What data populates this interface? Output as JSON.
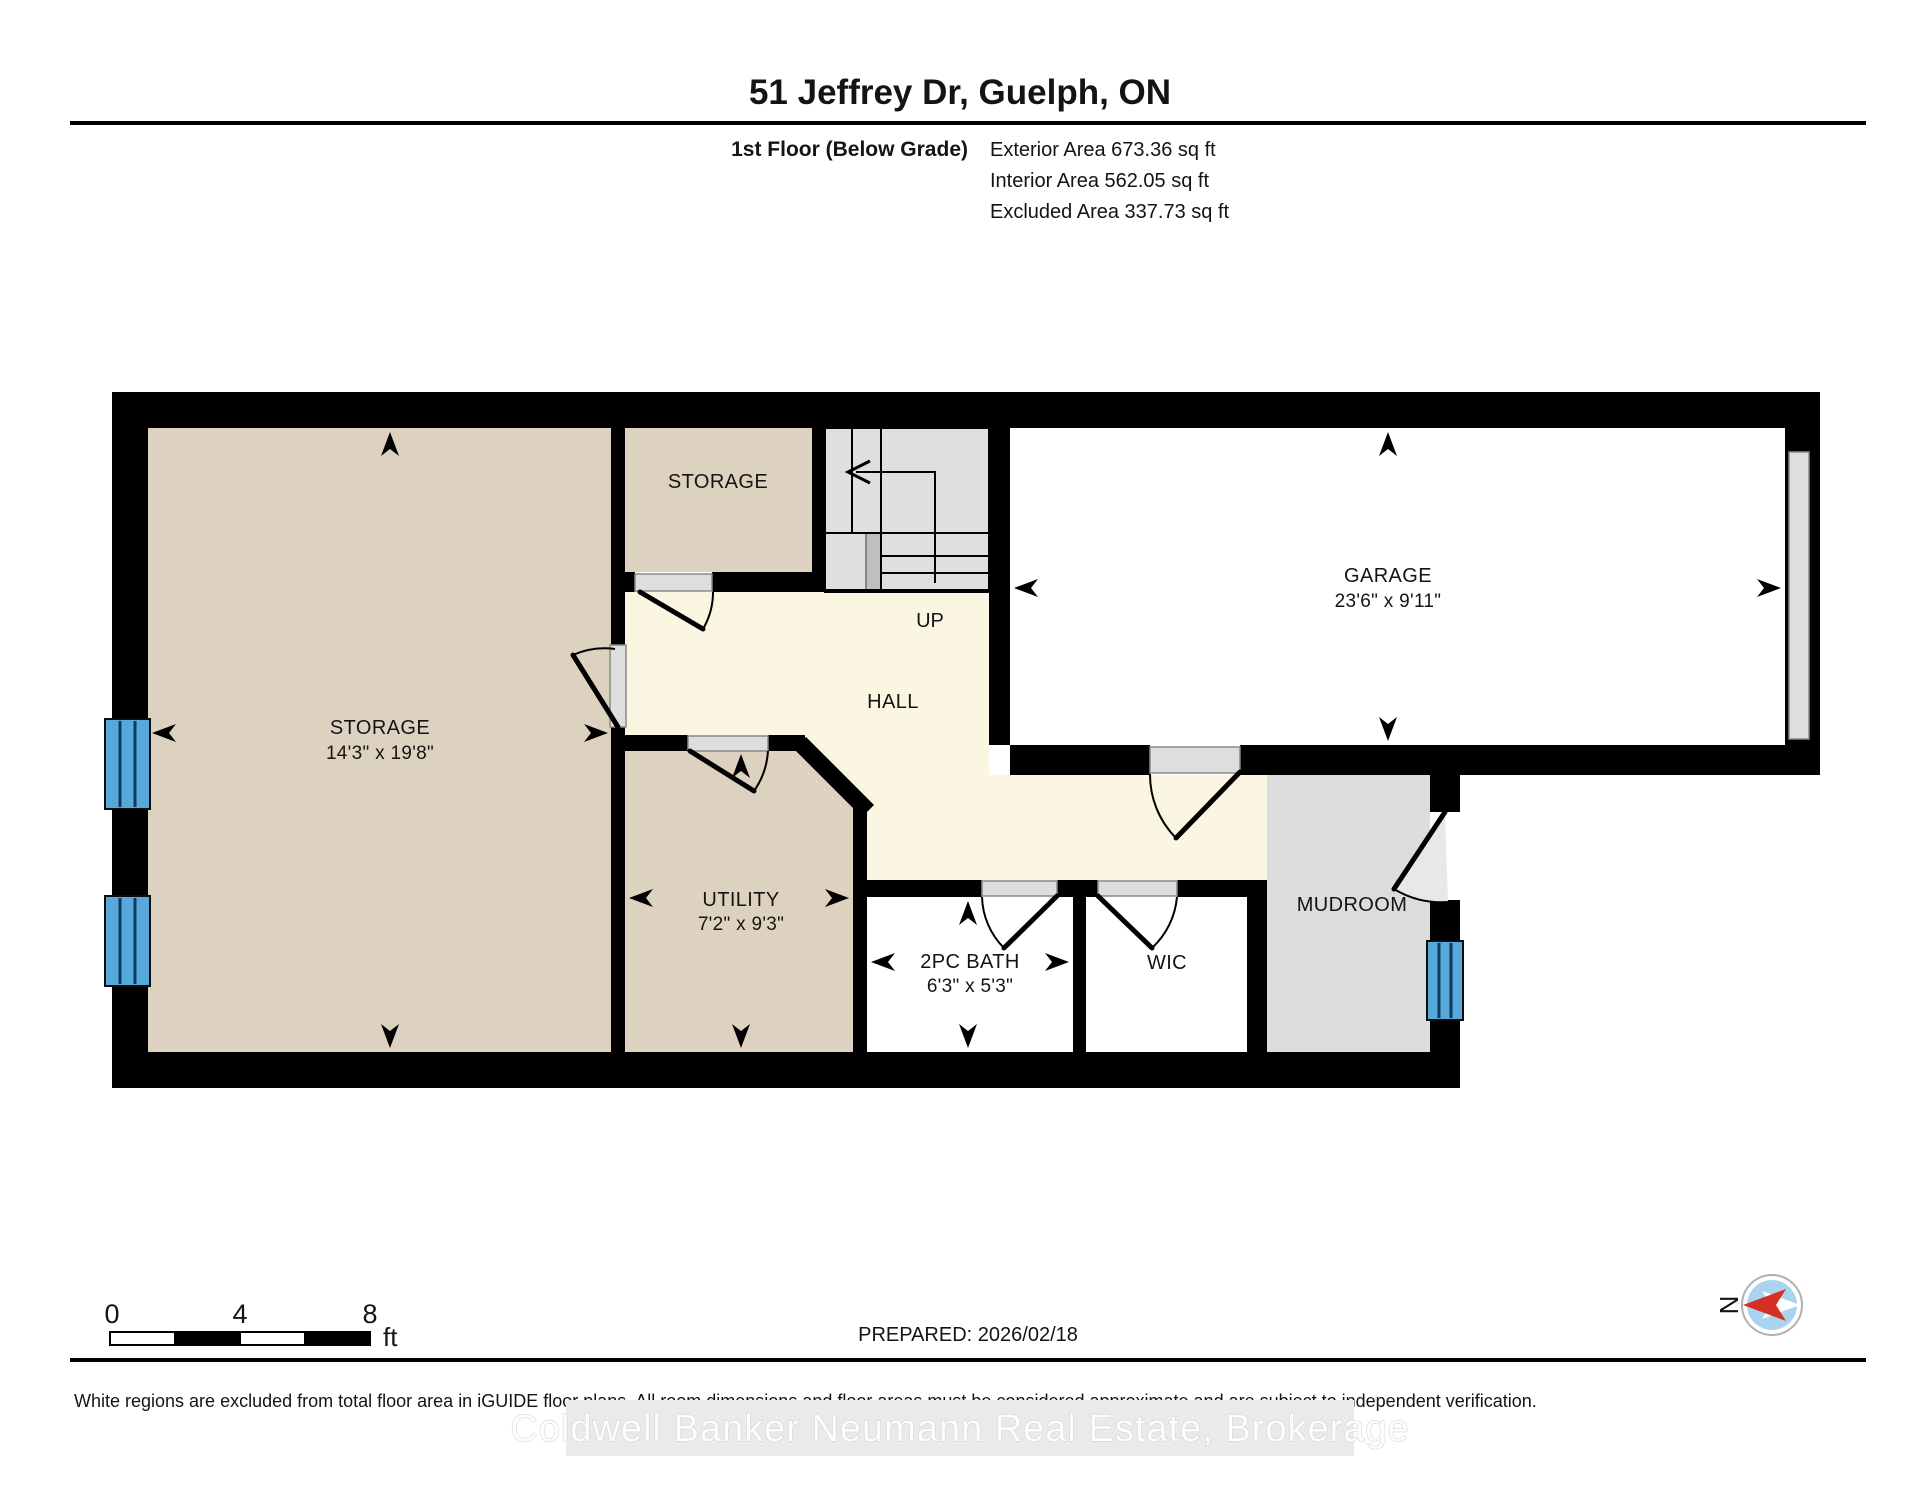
{
  "header": {
    "title": "51 Jeffrey Dr, Guelph, ON",
    "floor_label": "1st Floor (Below Grade)",
    "exterior_area": "Exterior Area 673.36 sq ft",
    "interior_area": "Interior Area 562.05 sq ft",
    "excluded_area": "Excluded Area 337.73 sq ft"
  },
  "rooms": {
    "storage_main": {
      "name": "STORAGE",
      "dims": "14'3\" x 19'8\""
    },
    "storage_small": {
      "name": "STORAGE"
    },
    "garage": {
      "name": "GARAGE",
      "dims": "23'6\" x 9'11\""
    },
    "hall": {
      "name": "HALL"
    },
    "utility": {
      "name": "UTILITY",
      "dims": "7'2\" x 9'3\""
    },
    "bath": {
      "name": "2PC BATH",
      "dims": "6'3\" x 5'3\""
    },
    "wic": {
      "name": "WIC"
    },
    "mudroom": {
      "name": "MUDROOM"
    },
    "stairs": {
      "direction_label": "UP"
    }
  },
  "footer": {
    "scale_bar": {
      "start": "0",
      "mid": "4",
      "end": "8",
      "unit": "ft"
    },
    "prepared": "PREPARED: 2026/02/18",
    "compass": {
      "north_label": "N"
    },
    "disclaimer": "White regions are excluded from total floor area in iGUIDE floor plans. All room dimensions and floor areas must be considered approximate and are subject to independent verification.",
    "watermark": "Coldwell Banker Neumann Real Estate, Brokerage"
  },
  "colors": {
    "wall": "#000000",
    "included_area_beige": "#ddd2c0",
    "hall_cream": "#fbf6e1",
    "excluded_white": "#ffffff",
    "gray_area": "#dcdcdc",
    "window_blue": "#58a9db",
    "compass_red": "#d32f23",
    "compass_blue": "#a9d3ef"
  }
}
